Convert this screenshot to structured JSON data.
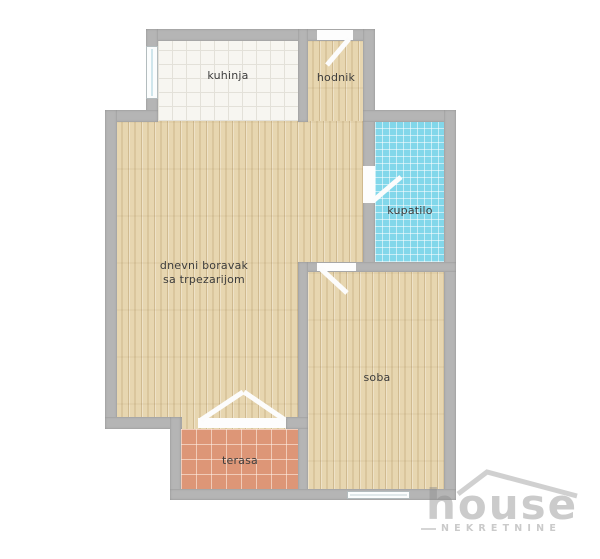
{
  "plan": {
    "type": "apartment-floor-plan",
    "rooms": {
      "kitchen": {
        "label": "kuhinja",
        "floor": "white-tile",
        "floor_color": "#f7f6f1"
      },
      "hallway": {
        "label": "hodnik",
        "floor": "wood",
        "floor_color": "#e7d6b0"
      },
      "bathroom": {
        "label": "kupatilo",
        "floor": "blue-tile",
        "floor_color": "#82d7ea"
      },
      "living_dining": {
        "label_line1": "dnevni boravak",
        "label_line2": "sa trpezarijom",
        "floor": "wood",
        "floor_color": "#e7d6b0"
      },
      "bedroom": {
        "label": "soba",
        "floor": "wood",
        "floor_color": "#e7d6b0"
      },
      "terrace": {
        "label": "terasa",
        "floor": "terracotta-tile",
        "floor_color": "#dd9677"
      }
    },
    "structure": {
      "wall_color": "#b5b5b5",
      "door_color": "#fcfcfc",
      "text_color": "#3d3d3d"
    }
  },
  "watermark": {
    "brand": "house",
    "subtitle": "NEKRETNINE",
    "color": "#d2d2d2"
  }
}
